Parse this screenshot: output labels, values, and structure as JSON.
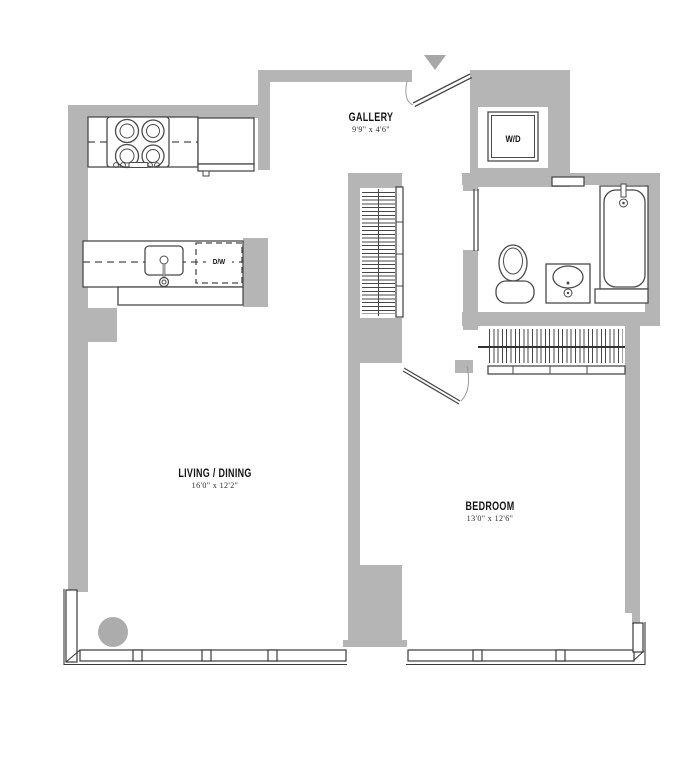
{
  "floor_plan": {
    "rooms": [
      {
        "id": "gallery",
        "name": "GALLERY",
        "dims": "9'9\" x 4'6\""
      },
      {
        "id": "living_dining",
        "name": "LIVING / DINING",
        "dims": "16'0\" x 12'2\""
      },
      {
        "id": "bedroom",
        "name": "BEDROOM",
        "dims": "13'0\" x 12'6\""
      }
    ],
    "appliances": {
      "washer_dryer": "W/D",
      "dishwasher": "D/W"
    },
    "colors": {
      "wall": "#b5b5b5",
      "fixture_line": "#4a4a4a",
      "window_line": "#3a3a3a",
      "text": "#141414"
    }
  }
}
